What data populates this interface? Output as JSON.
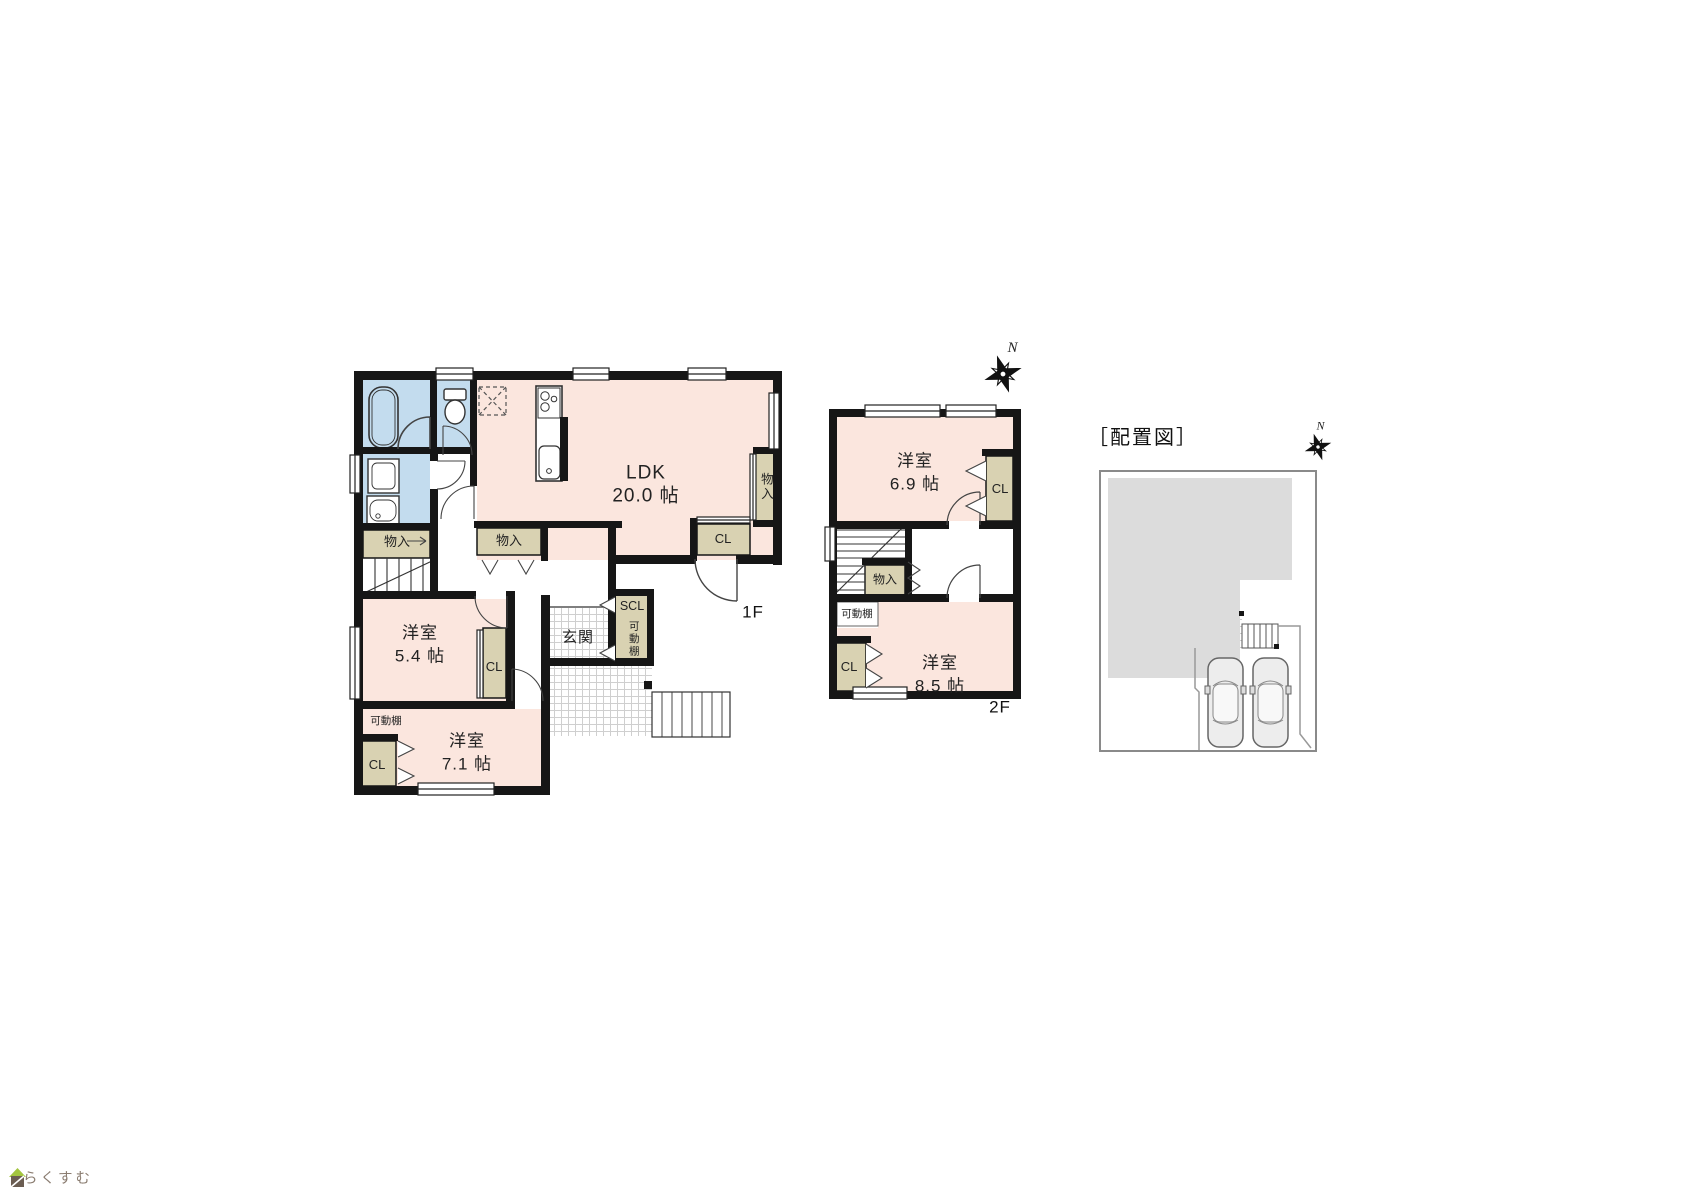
{
  "colors": {
    "room_pink": "#fbe6de",
    "wet_blue": "#c3dcee",
    "closet_beige": "#d9d2b2",
    "wall_black": "#161616",
    "building_gray": "#dcdcdc",
    "logo_green": "#a3c53f",
    "logo_brown": "#6b5d52",
    "logo_text_brown": "#8a7c70"
  },
  "floor1": {
    "label": "1F",
    "ldk": {
      "name": "LDK",
      "size": "20.0 帖"
    },
    "room_54": {
      "name": "洋室",
      "size": "5.4 帖"
    },
    "room_71": {
      "name": "洋室",
      "size": "7.1 帖"
    },
    "entrance": "玄関",
    "scl": "SCL",
    "shelf_scl": "可動棚",
    "shelf_71": "可動棚",
    "closet_54": "CL",
    "closet_71": "CL",
    "closet_entrance": "CL",
    "storage_stairs": "物入",
    "storage_hall": "物入",
    "storage_ldk": "物入"
  },
  "floor2": {
    "label": "2F",
    "room_69": {
      "name": "洋室",
      "size": "6.9 帖"
    },
    "room_85": {
      "name": "洋室",
      "size": "8.5 帖"
    },
    "closet_69": "CL",
    "closet_85": "CL",
    "storage": "物入",
    "shelf": "可動棚"
  },
  "site": {
    "title": "［配置図］"
  },
  "compass": {
    "label": "N"
  },
  "logo": {
    "text": "らくすむ"
  }
}
